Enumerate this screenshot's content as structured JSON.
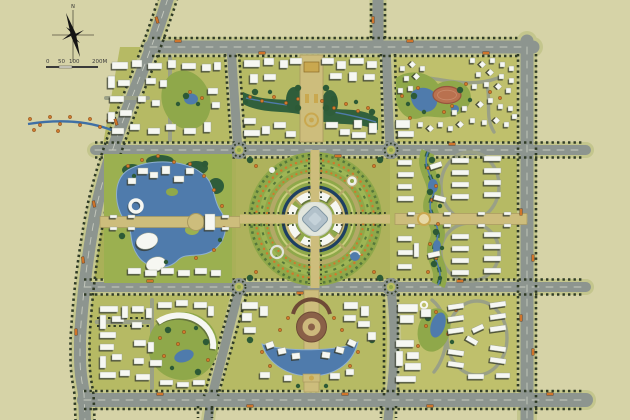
{
  "compass": {
    "label": "N",
    "icon": "north-arrow-icon"
  },
  "scale_bar": {
    "labels": [
      "0",
      "50",
      "100",
      "200M"
    ]
  },
  "palette": {
    "background": "#d6d3a7",
    "road": "#8d958f",
    "road_centerline": "#c6cabf",
    "verge": "#c4c68d",
    "block_green": "#b6ba64",
    "park_green": "#8fa84a",
    "tree_dark": "#2d5a36",
    "tree_orange": "#d0792c",
    "water": "#4f7bac",
    "building": "#f6f7f2",
    "building_shadow": "#34382d",
    "axis_tan": "#cdbd7c",
    "plaza_gold": "#c9a84f",
    "plaza_brown": "#8a6048",
    "running_track": "#b9714f",
    "ring_navy": "#1f3f63",
    "medallion_blue": "#b2c1ca"
  }
}
